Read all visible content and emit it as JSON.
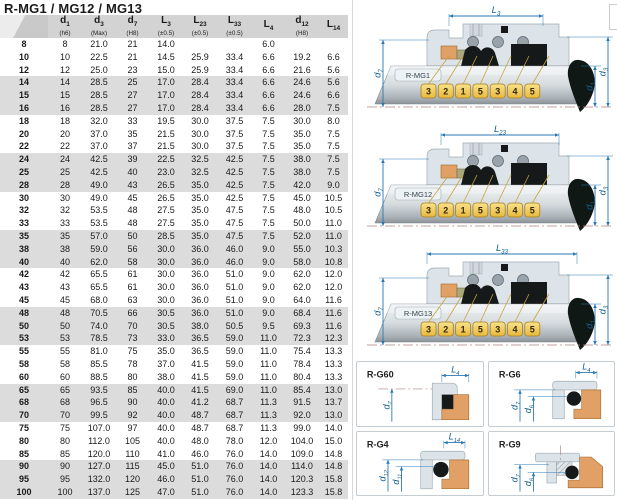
{
  "title": "R-MG1 / MG12 / MG13",
  "table": {
    "headers": [
      {
        "base": "",
        "sub": "",
        "note": ""
      },
      {
        "base": "d",
        "sub": "1",
        "note": "(h6)"
      },
      {
        "base": "d",
        "sub": "3",
        "note": "(Max)"
      },
      {
        "base": "d",
        "sub": "7",
        "note": "(H8)"
      },
      {
        "base": "L",
        "sub": "3",
        "note": "(±0.5)"
      },
      {
        "base": "L",
        "sub": "23",
        "note": "(±0.5)"
      },
      {
        "base": "L",
        "sub": "33",
        "note": "(±0.5)"
      },
      {
        "base": "L",
        "sub": "4",
        "note": ""
      },
      {
        "base": "d",
        "sub": "12",
        "note": "(H8)"
      },
      {
        "base": "L",
        "sub": "14",
        "note": ""
      }
    ],
    "rows": [
      [
        "8",
        "8",
        "21.0",
        "21",
        "14.0",
        "",
        "",
        "6.0",
        "",
        ""
      ],
      [
        "10",
        "10",
        "22.5",
        "21",
        "14.5",
        "25.9",
        "33.4",
        "6.6",
        "19.2",
        "6.6"
      ],
      [
        "12",
        "12",
        "25.0",
        "23",
        "15.0",
        "25.9",
        "33.4",
        "6.6",
        "21.6",
        "5.6"
      ],
      [
        "14",
        "14",
        "28.5",
        "25",
        "17.0",
        "28.4",
        "33.4",
        "6.6",
        "24.6",
        "5.6"
      ],
      [
        "15",
        "15",
        "28.5",
        "27",
        "17.0",
        "28.4",
        "33.4",
        "6.6",
        "24.6",
        "6.6"
      ],
      [
        "16",
        "16",
        "28.5",
        "27",
        "17.0",
        "28.4",
        "33.4",
        "6.6",
        "28.0",
        "7.5"
      ],
      [
        "18",
        "18",
        "32.0",
        "33",
        "19.5",
        "30.0",
        "37.5",
        "7.5",
        "30.0",
        "8.0"
      ],
      [
        "20",
        "20",
        "37.0",
        "35",
        "21.5",
        "30.0",
        "37.5",
        "7.5",
        "35.0",
        "7.5"
      ],
      [
        "22",
        "22",
        "37.0",
        "37",
        "21.5",
        "30.0",
        "37.5",
        "7.5",
        "35.0",
        "7.5"
      ],
      [
        "24",
        "24",
        "42.5",
        "39",
        "22.5",
        "32.5",
        "42.5",
        "7.5",
        "38.0",
        "7.5"
      ],
      [
        "25",
        "25",
        "42.5",
        "40",
        "23.0",
        "32.5",
        "42.5",
        "7.5",
        "38.0",
        "7.5"
      ],
      [
        "28",
        "28",
        "49.0",
        "43",
        "26.5",
        "35.0",
        "42.5",
        "7.5",
        "42.0",
        "9.0"
      ],
      [
        "30",
        "30",
        "49.0",
        "45",
        "26.5",
        "35.0",
        "42.5",
        "7.5",
        "45.0",
        "10.5"
      ],
      [
        "32",
        "32",
        "53.5",
        "48",
        "27.5",
        "35.0",
        "47.5",
        "7.5",
        "48.0",
        "10.5"
      ],
      [
        "33",
        "33",
        "53.5",
        "48",
        "27.5",
        "35.0",
        "47.5",
        "7.5",
        "50.0",
        "11.0"
      ],
      [
        "35",
        "35",
        "57.0",
        "50",
        "28.5",
        "35.0",
        "47.5",
        "7.5",
        "52.0",
        "11.0"
      ],
      [
        "38",
        "38",
        "59.0",
        "56",
        "30.0",
        "36.0",
        "46.0",
        "9.0",
        "55.0",
        "10.3"
      ],
      [
        "40",
        "40",
        "62.0",
        "58",
        "30.0",
        "36.0",
        "46.0",
        "9.0",
        "58.0",
        "10.8"
      ],
      [
        "42",
        "42",
        "65.5",
        "61",
        "30.0",
        "36.0",
        "51.0",
        "9.0",
        "62.0",
        "12.0"
      ],
      [
        "43",
        "43",
        "65.5",
        "61",
        "30.0",
        "36.0",
        "51.0",
        "9.0",
        "62.0",
        "12.0"
      ],
      [
        "45",
        "45",
        "68.0",
        "63",
        "30.0",
        "36.0",
        "51.0",
        "9.0",
        "64.0",
        "11.6"
      ],
      [
        "48",
        "48",
        "70.5",
        "66",
        "30.5",
        "36.0",
        "51.0",
        "9.0",
        "68.4",
        "11.6"
      ],
      [
        "50",
        "50",
        "74.0",
        "70",
        "30.5",
        "38.0",
        "50.5",
        "9.5",
        "69.3",
        "11.6"
      ],
      [
        "53",
        "53",
        "78.5",
        "73",
        "33.0",
        "36.5",
        "59.0",
        "11.0",
        "72.3",
        "12.3"
      ],
      [
        "55",
        "55",
        "81.0",
        "75",
        "35.0",
        "36.5",
        "59.0",
        "11.0",
        "75.4",
        "13.3"
      ],
      [
        "58",
        "58",
        "85.5",
        "78",
        "37.0",
        "41.5",
        "59.0",
        "11.0",
        "78.4",
        "13.3"
      ],
      [
        "60",
        "60",
        "88.5",
        "80",
        "38.0",
        "41.5",
        "59.0",
        "11.0",
        "80.4",
        "13.3"
      ],
      [
        "65",
        "65",
        "93.5",
        "85",
        "40.0",
        "41.5",
        "69.0",
        "11.0",
        "85.4",
        "13.0"
      ],
      [
        "68",
        "68",
        "96.5",
        "90",
        "40.0",
        "41.2",
        "68.7",
        "11.3",
        "91.5",
        "13.7"
      ],
      [
        "70",
        "70",
        "99.5",
        "92",
        "40.0",
        "48.7",
        "68.7",
        "11.3",
        "92.0",
        "13.0"
      ],
      [
        "75",
        "75",
        "107.0",
        "97",
        "40.0",
        "48.7",
        "68.7",
        "11.3",
        "99.0",
        "14.0"
      ],
      [
        "80",
        "80",
        "112.0",
        "105",
        "40.0",
        "48.0",
        "78.0",
        "12.0",
        "104.0",
        "15.0"
      ],
      [
        "85",
        "85",
        "120.0",
        "110",
        "41.0",
        "46.0",
        "76.0",
        "14.0",
        "109.0",
        "14.8"
      ],
      [
        "90",
        "90",
        "127.0",
        "115",
        "45.0",
        "51.0",
        "76.0",
        "14.0",
        "114.0",
        "14.8"
      ],
      [
        "95",
        "95",
        "132.0",
        "120",
        "46.0",
        "51.0",
        "76.0",
        "14.0",
        "120.3",
        "15.8"
      ],
      [
        "100",
        "100",
        "137.0",
        "125",
        "47.0",
        "51.0",
        "76.0",
        "14.0",
        "123.3",
        "15.8"
      ]
    ]
  },
  "diagrams": [
    {
      "label": "R-MG1",
      "top_dim": {
        "base": "L",
        "sub": "3"
      },
      "left_dim": {
        "base": "d",
        "sub": "7"
      },
      "right_dims": [
        {
          "base": "d",
          "sub": "1"
        },
        {
          "base": "d",
          "sub": "3"
        }
      ],
      "callouts": [
        "3",
        "2",
        "1",
        "5",
        "3",
        "4",
        "5"
      ]
    },
    {
      "label": "R-MG12",
      "top_dim": {
        "base": "L",
        "sub": "23"
      },
      "left_dim": {
        "base": "d",
        "sub": "7"
      },
      "right_dims": [
        {
          "base": "d",
          "sub": "1"
        },
        {
          "base": "d",
          "sub": "3"
        }
      ],
      "callouts": [
        "3",
        "2",
        "1",
        "5",
        "3",
        "4",
        "5"
      ]
    },
    {
      "label": "R-MG13",
      "top_dim": {
        "base": "L",
        "sub": "33"
      },
      "left_dim": {
        "base": "d",
        "sub": "7"
      },
      "right_dims": [
        {
          "base": "d",
          "sub": "1"
        },
        {
          "base": "d",
          "sub": "3"
        }
      ],
      "callouts": [
        "3",
        "2",
        "1",
        "5",
        "3",
        "4",
        "5"
      ]
    }
  ],
  "panels": [
    {
      "label": "R-G60",
      "variant": "g60",
      "top_dim": {
        "base": "L",
        "sub": "4"
      },
      "left_dims": [
        {
          "base": "d",
          "sub": "7"
        }
      ]
    },
    {
      "label": "R-G6",
      "variant": "g6",
      "top_dim": {
        "base": "L",
        "sub": "4"
      },
      "left_dims": [
        {
          "base": "d",
          "sub": "7"
        },
        {
          "base": "d",
          "sub": "6"
        }
      ]
    },
    {
      "label": "R-G4",
      "variant": "g4",
      "top_dim": {
        "base": "L",
        "sub": "14"
      },
      "left_dims": [
        {
          "base": "d",
          "sub": "12"
        },
        {
          "base": "d",
          "sub": "11"
        }
      ]
    },
    {
      "label": "R-G9",
      "variant": "g9",
      "top_dim": null,
      "left_dims": [
        {
          "base": "d",
          "sub": "7"
        },
        {
          "base": "d",
          "sub": "6"
        }
      ]
    }
  ],
  "colors": {
    "header_bg": "#d3d3d3",
    "row_alt_bg": "#dcdcdc",
    "dim_line": "#2878b4",
    "callout_gold": "#f2cf5b",
    "housing": "#dde4e9",
    "orange": "#e0a066",
    "olive": "#a8a87c",
    "seal_black": "#16191a",
    "centerline": "#b08484"
  }
}
